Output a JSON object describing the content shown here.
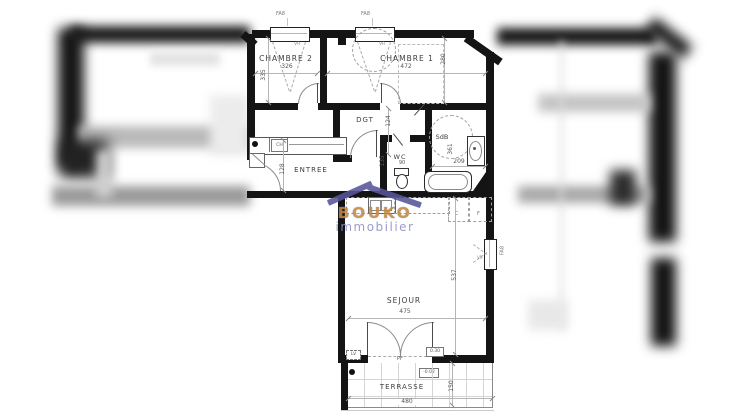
{
  "watermark": {
    "brand": "BOUKO",
    "tagline": "immobilier"
  },
  "rooms": {
    "chambre2": {
      "name": "CHAMBRE 2",
      "width": "326",
      "height": "335"
    },
    "chambre1": {
      "name": "CHAMBRE 1",
      "width": "472",
      "height": "280"
    },
    "dgt": {
      "name": "DGT",
      "height": "124"
    },
    "entree": {
      "name": "ENTREE",
      "height": "128"
    },
    "wc": {
      "name": "WC",
      "width": "90",
      "height": "135"
    },
    "sdb": {
      "name": "SdB",
      "width": "209",
      "height": "361"
    },
    "sejour": {
      "name": "SEJOUR",
      "width": "475",
      "height": "537"
    },
    "terrasse": {
      "name": "TERRASSE",
      "width": "480",
      "height": "150"
    }
  },
  "openings": {
    "window_top_left": "FA8",
    "window_top_right": "FA8",
    "window_sejour": "FA8",
    "shutter_left": "VR",
    "shutter_right": "VR",
    "shutter_sejour": "VR",
    "french_door": "PF"
  },
  "annotations": {
    "boiler": "CH",
    "cooker": "C",
    "fridge": "F",
    "lv": "LV",
    "level_door": "0.30",
    "level_terrace": "-0.02"
  },
  "colors": {
    "wall": "#141414",
    "brand_roof": "#56559a",
    "brand_text": "#c28a3f",
    "brand_tagline": "#8f8ec7"
  }
}
